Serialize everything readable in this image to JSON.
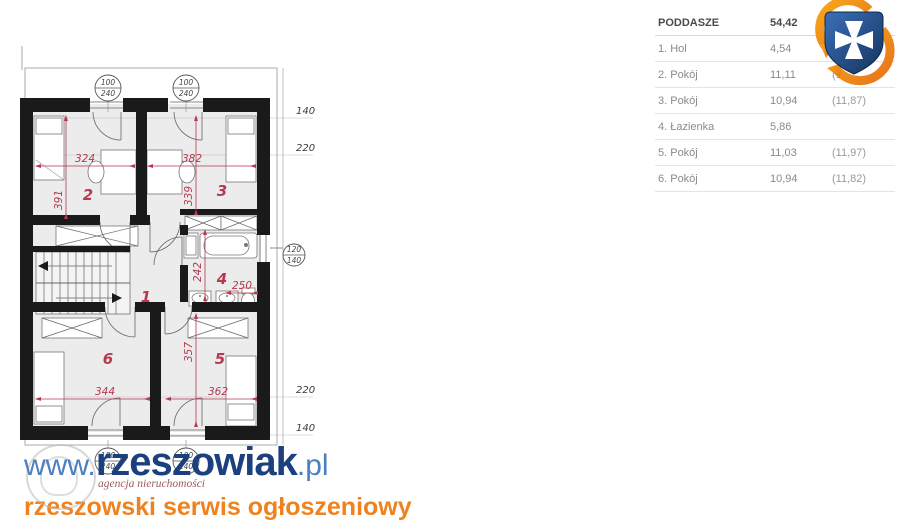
{
  "plan": {
    "room_numbers": {
      "hol": "1",
      "pokoj2": "2",
      "pokoj3": "3",
      "lazienka": "4",
      "pokoj5": "5",
      "pokoj6": "6"
    },
    "dims": {
      "r2_w": "324",
      "r2_h": "391",
      "r3_w": "382",
      "r3_h": "339",
      "r4_h": "242",
      "r4_w": "250",
      "r5_h": "357",
      "r5_w": "362",
      "r6_w": "344"
    },
    "side_dims": {
      "top_140": "140",
      "top_220": "220",
      "bottom_220": "220",
      "bottom_140": "140"
    },
    "windows": {
      "top_left": {
        "w": "100",
        "h": "240"
      },
      "top_right": {
        "w": "100",
        "h": "240"
      },
      "right": {
        "w": "120",
        "h": "140"
      },
      "bottom_left": {
        "w": "100",
        "h": "240"
      },
      "bottom_right": {
        "w": "100",
        "h": "240"
      }
    }
  },
  "table": {
    "header": {
      "name": "PODDASZE",
      "value": "54,42"
    },
    "rows": [
      {
        "name": "1. Hol",
        "area": "4,54",
        "alt": ""
      },
      {
        "name": "2. Pokój",
        "area": "11,11",
        "alt": "(1"
      },
      {
        "name": "3. Pokój",
        "area": "10,94",
        "alt": "(11,87)"
      },
      {
        "name": "4. Łazienka",
        "area": "5,86",
        "alt": ""
      },
      {
        "name": "5. Pokój",
        "area": "11,03",
        "alt": "(11,97)"
      },
      {
        "name": "6. Pokój",
        "area": "10,94",
        "alt": "(11,82)"
      }
    ]
  },
  "watermark": {
    "url_prefix": "www.",
    "url_main": "rzeszowiak",
    "url_suffix": ".pl",
    "agency": "agencja nieruchomości",
    "tagline": "rzeszowski serwis ogłoszeniowy"
  },
  "colors": {
    "dimension_red": "#b5394f",
    "wall_black": "#1a1a1a",
    "tagline_orange": "#f0821e",
    "brand_blue_dark": "#1c3f7d",
    "brand_blue": "#4c7fc0",
    "crest_blue": "#2d62a8",
    "crest_orange": "#f08a1d"
  }
}
